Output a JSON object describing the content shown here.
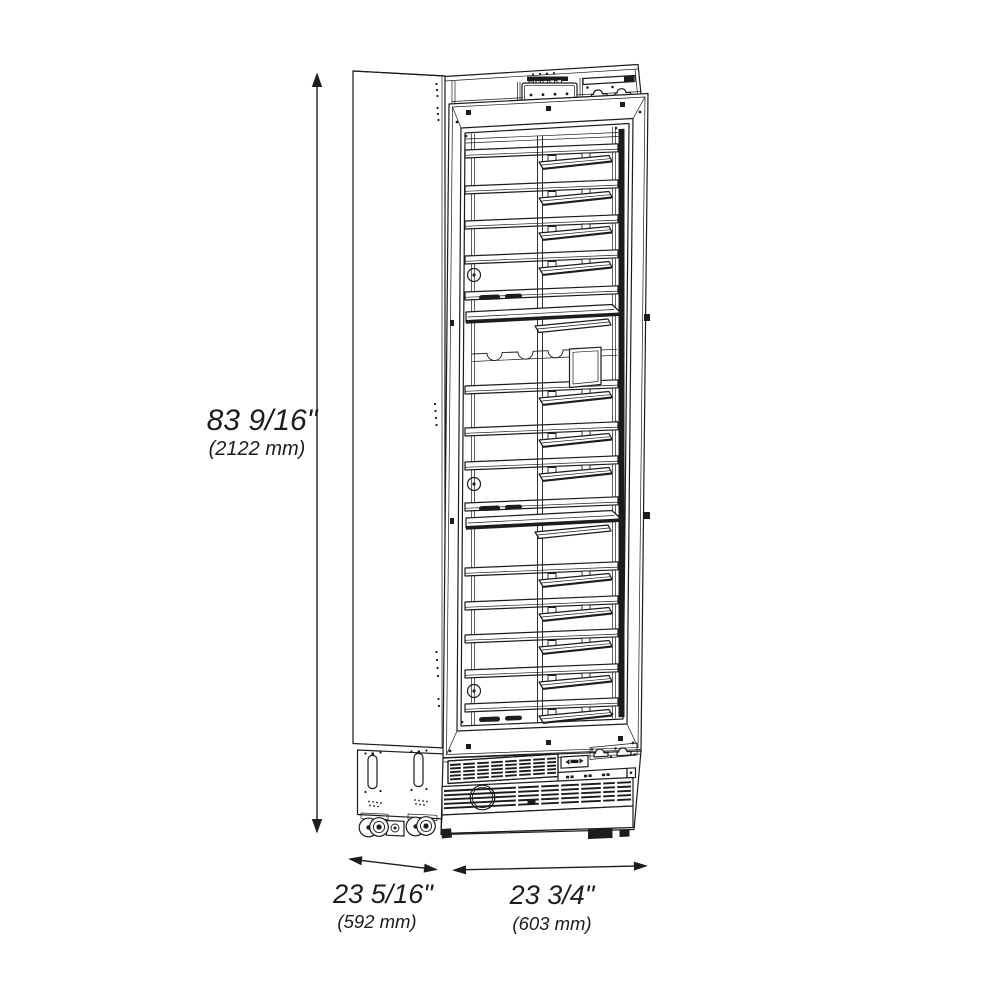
{
  "canvas": {
    "background": "#ffffff",
    "line_color": "#1c1c1c"
  },
  "figure": {
    "description": "Technical line drawing of a tall single glass-door wine cooler shown in three-quarter view with interior pull-out shelves, display racks, bottle cradle shelf, lower ventilation grilles, casters and leveling feet"
  },
  "dimensions": {
    "height": {
      "inches": "83 9/16\"",
      "millimeters": "(2122 mm)"
    },
    "depth": {
      "inches": "23 5/16\"",
      "millimeters": "(592 mm)"
    },
    "width": {
      "inches": "23 3/4\"",
      "millimeters": "(603 mm)"
    }
  }
}
